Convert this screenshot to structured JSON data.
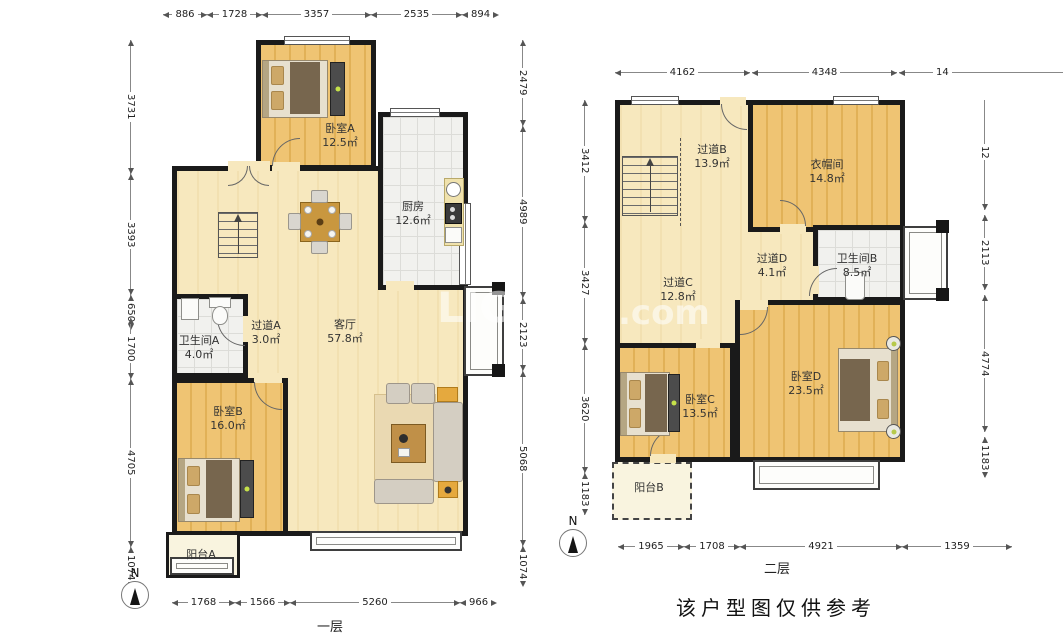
{
  "compass": "N",
  "footer_note": "该户型图仅供参考",
  "watermark": {
    "left": "LIG",
    "right": ".com"
  },
  "floor1": {
    "caption": "一层",
    "rooms": {
      "bedroomA": {
        "name": "卧室A",
        "area": "12.5㎡"
      },
      "kitchen": {
        "name": "厨房",
        "area": "12.6㎡"
      },
      "living": {
        "name": "客厅",
        "area": "57.8㎡"
      },
      "hallA": {
        "name": "过道A",
        "area": "3.0㎡"
      },
      "bathA": {
        "name": "卫生间A",
        "area": "4.0㎡"
      },
      "bedroomB": {
        "name": "卧室B",
        "area": "16.0㎡"
      },
      "balconyA": {
        "name": "阳台A"
      }
    },
    "dims_top": [
      "886",
      "1728",
      "3357",
      "2535",
      "894"
    ],
    "dims_bottom": [
      "1768",
      "1566",
      "5260",
      "966"
    ],
    "dims_left": [
      "3731",
      "3393",
      "650",
      "1700",
      "4705",
      "1074"
    ],
    "dims_right": [
      "2479",
      "4989",
      "2123",
      "5068",
      "1074"
    ]
  },
  "floor2": {
    "caption": "二层",
    "rooms": {
      "hallB": {
        "name": "过道B",
        "area": "13.9㎡"
      },
      "cloakroom": {
        "name": "衣帽间",
        "area": "14.8㎡"
      },
      "bathB": {
        "name": "卫生间B",
        "area": "8.5㎡"
      },
      "hallC": {
        "name": "过道C",
        "area": "12.8㎡"
      },
      "hallD": {
        "name": "过道D",
        "area": "4.1㎡"
      },
      "bedroomC": {
        "name": "卧室C",
        "area": "13.5㎡"
      },
      "bedroomD": {
        "name": "卧室D",
        "area": "23.5㎡"
      },
      "balconyB": {
        "name": "阳台B"
      }
    },
    "dims_top": [
      "4162",
      "4348",
      "14"
    ],
    "dims_bottom": [
      "1965",
      "1708",
      "4921",
      "1359"
    ],
    "dims_left": [
      "3412",
      "3427",
      "3620",
      "1183"
    ],
    "dims_right": [
      "12",
      "2113",
      "4774",
      "1183"
    ]
  }
}
